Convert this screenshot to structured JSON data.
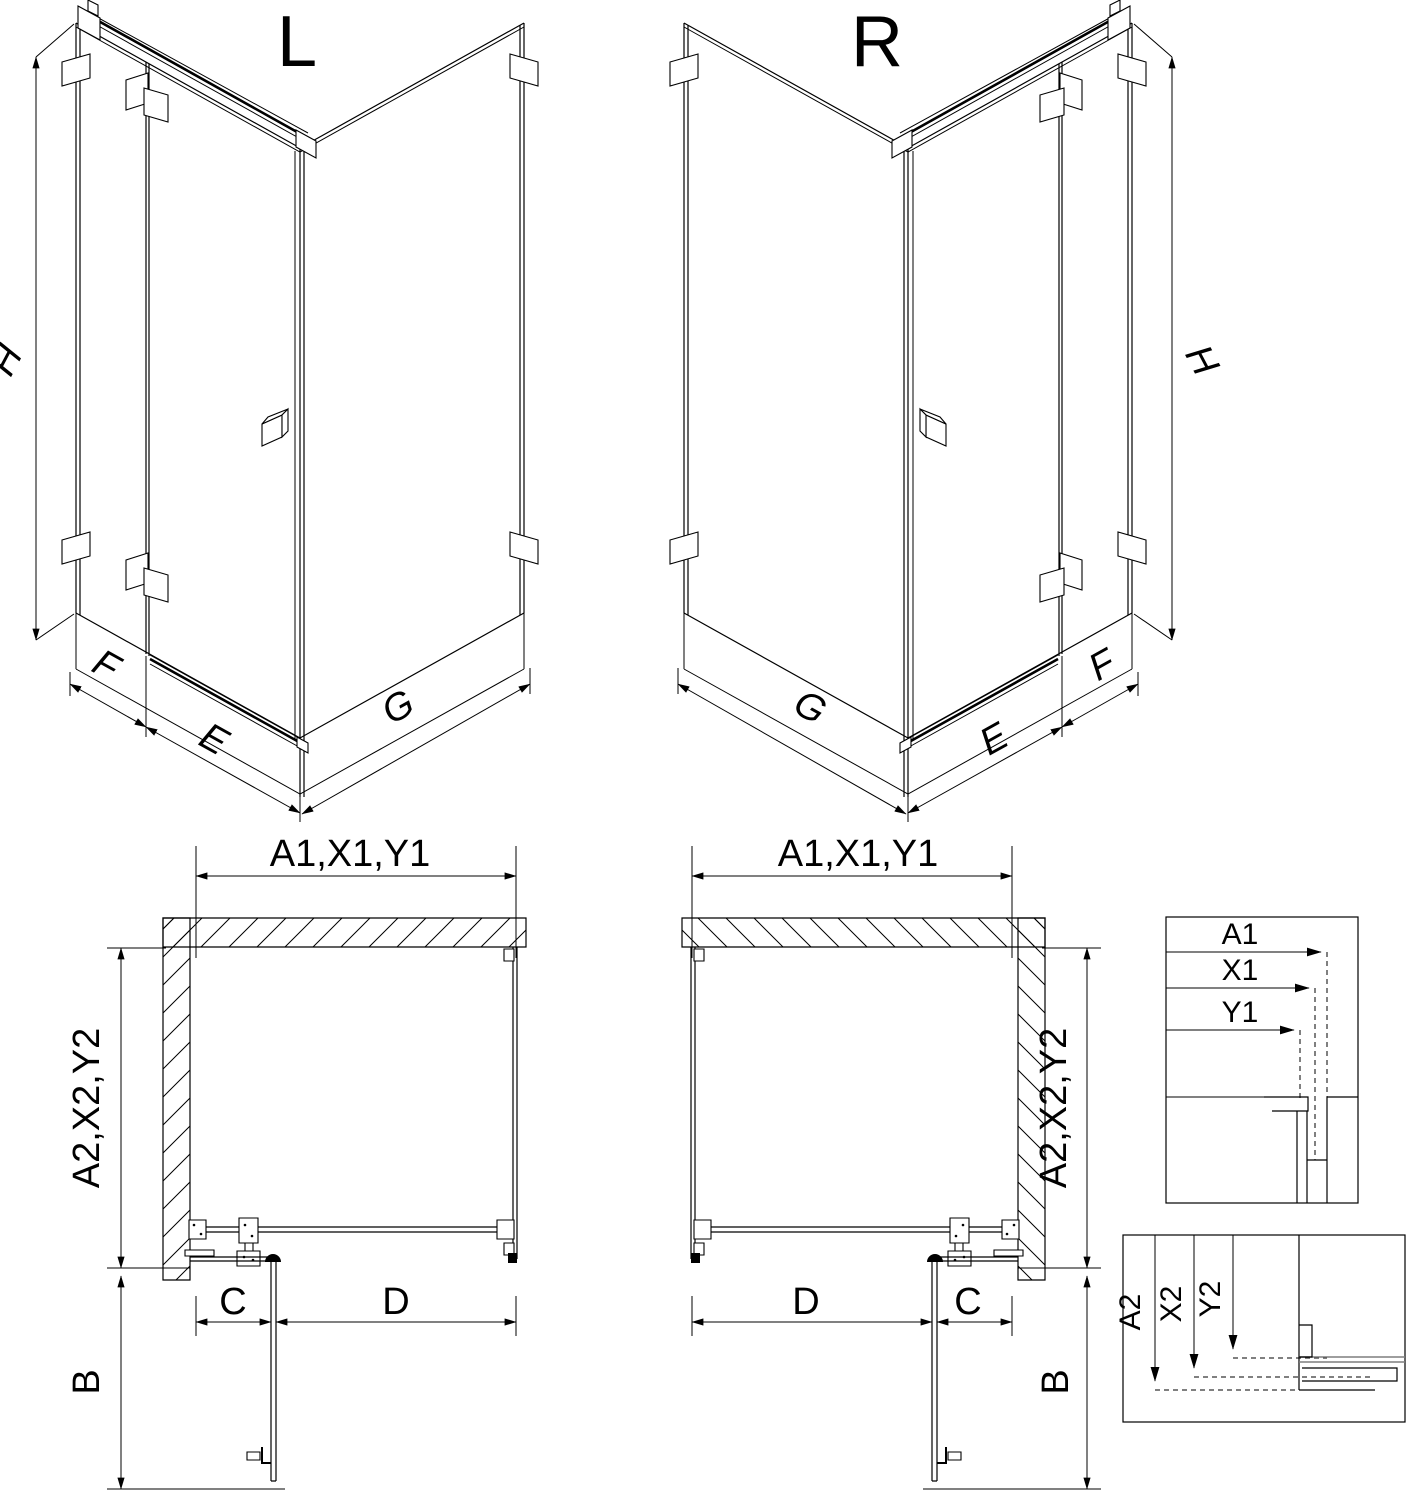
{
  "colors": {
    "background": "#ffffff",
    "line": "#000000",
    "glass_section_gray": "#7f7f7f"
  },
  "iso_left": {
    "variant_label": "L",
    "height_label": "H",
    "side_panel_label": "F",
    "door_label": "E",
    "return_panel_label": "G"
  },
  "iso_right": {
    "variant_label": "R",
    "height_label": "H",
    "side_panel_label": "F",
    "door_label": "E",
    "return_panel_label": "G"
  },
  "plan_left": {
    "width_label": "A1,X1,Y1",
    "depth_label": "A2,X2,Y2",
    "fixed_segment_label": "C",
    "door_segment_label": "D",
    "door_swing_label": "B"
  },
  "plan_right": {
    "width_label": "A1,X1,Y1",
    "depth_label": "A2,X2,Y2",
    "fixed_segment_label": "C",
    "door_segment_label": "D",
    "door_swing_label": "B"
  },
  "detail_width": {
    "labels": [
      "A1",
      "X1",
      "Y1"
    ]
  },
  "detail_depth": {
    "labels": [
      "A2",
      "X2",
      "Y2"
    ]
  }
}
